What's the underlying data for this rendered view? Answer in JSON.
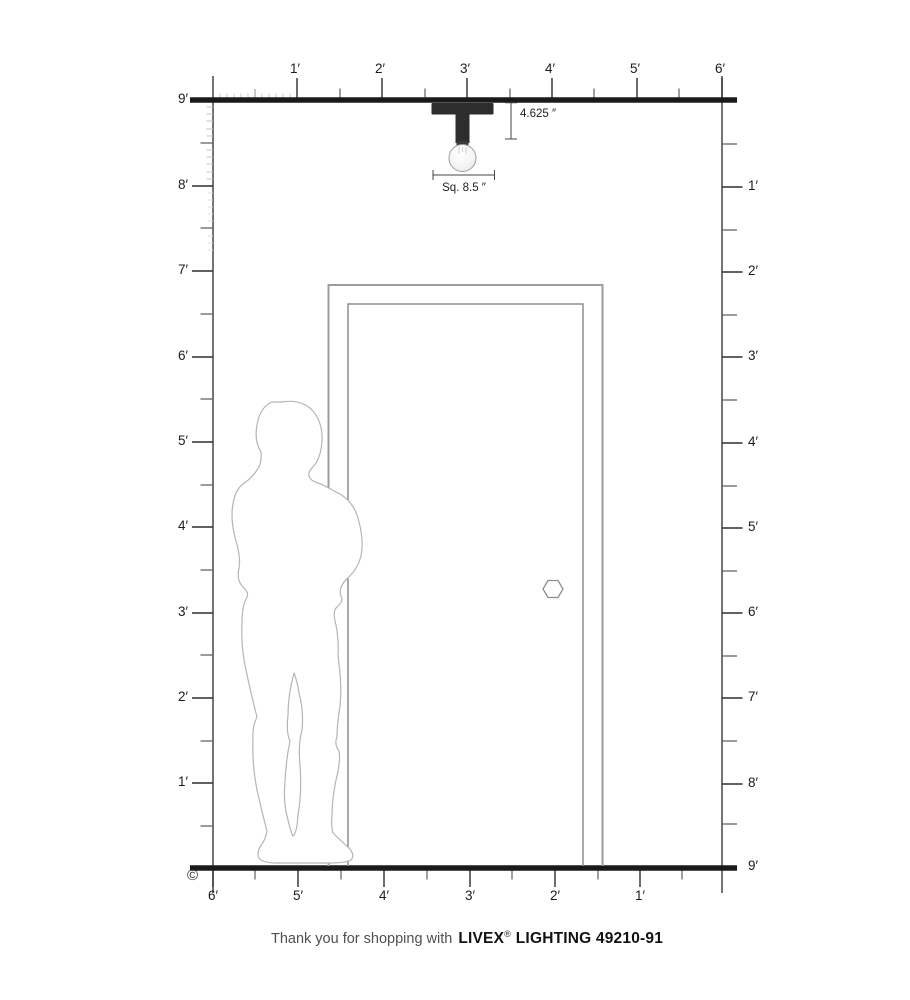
{
  "rulers": {
    "top": {
      "labels": [
        "1′",
        "2′",
        "3′",
        "4′",
        "5′",
        "6′"
      ]
    },
    "left": {
      "labels": [
        "9′",
        "8′",
        "7′",
        "6′",
        "5′",
        "4′",
        "3′",
        "2′",
        "1′"
      ]
    },
    "right": {
      "labels": [
        "1′",
        "2′",
        "3′",
        "4′",
        "5′",
        "6′",
        "7′",
        "8′",
        "9′"
      ]
    },
    "bottom": {
      "labels": [
        "6′",
        "5′",
        "4′",
        "3′",
        "2′",
        "1′"
      ]
    }
  },
  "dimensions": {
    "fixture_height": "4.625 ″",
    "fixture_width": "Sq. 8.5 ″"
  },
  "footer": {
    "prefix": "Thank you for shopping with",
    "brand": "LIVEX",
    "registered": "®",
    "model_text": "LIGHTING 49210-91",
    "copyright": "©"
  },
  "colors": {
    "structure_line": "#1a1a1a",
    "tick_major": "#3a3a3a",
    "tick_minor": "#6a6a6a",
    "tick_fine": "#c4c4c4",
    "door_frame": "#9c9c9c",
    "figure_outline": "#b5b5b5",
    "fixture_body": "#2d2d2d"
  }
}
